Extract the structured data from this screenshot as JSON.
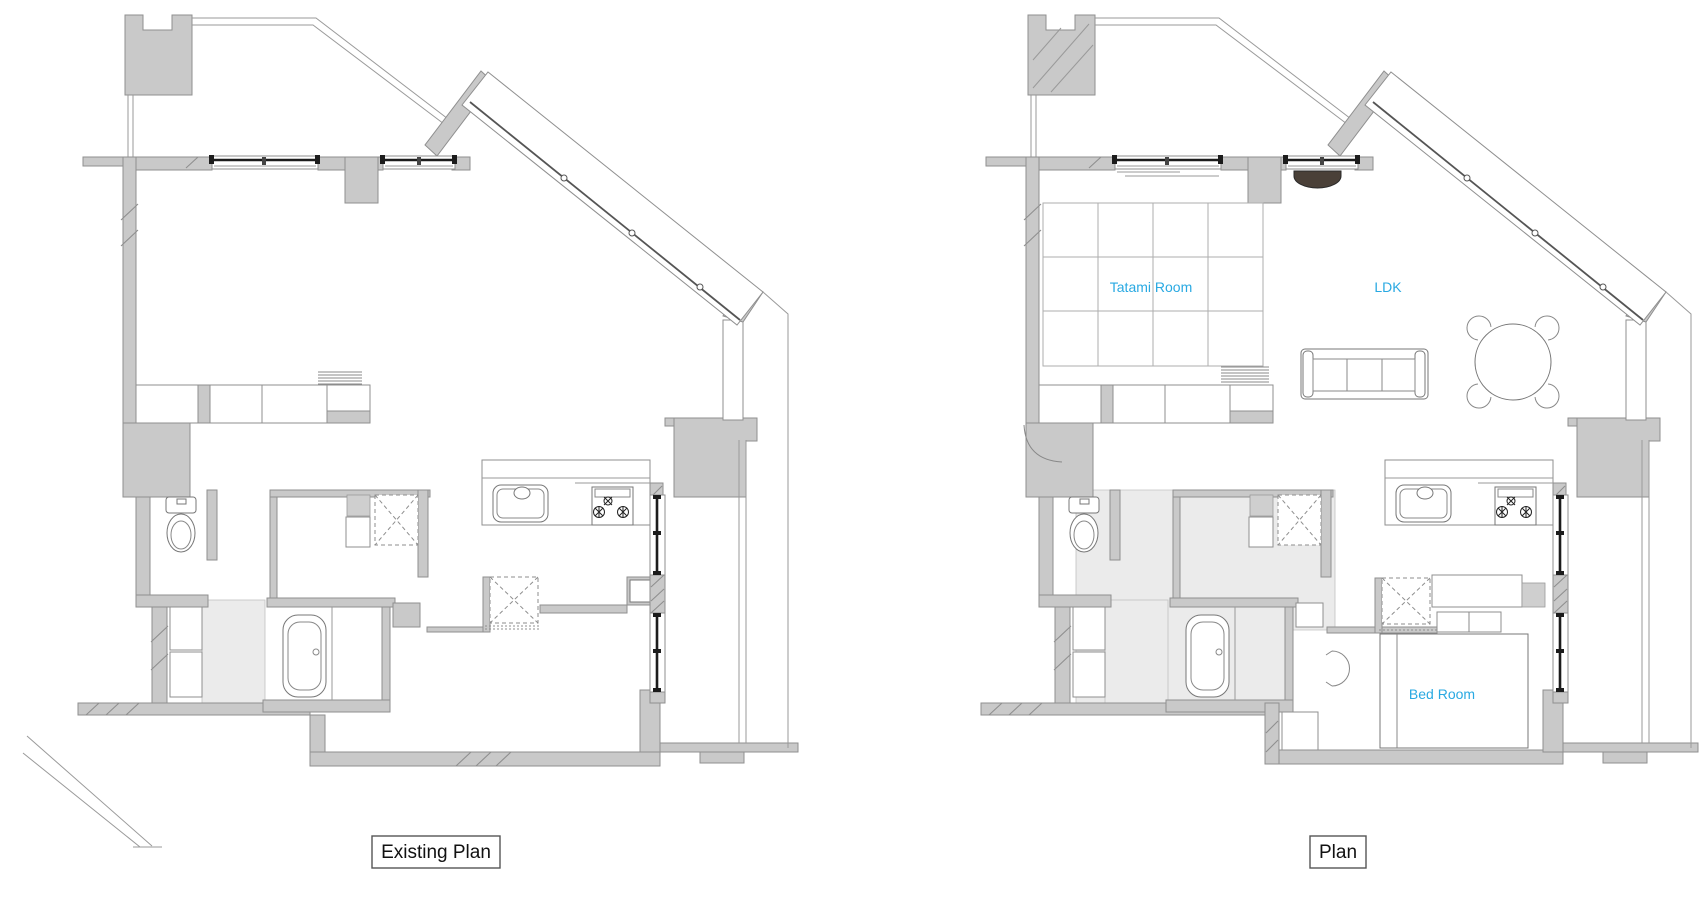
{
  "document": {
    "kind": "architectural-floor-plan-comparison",
    "background": "#ffffff"
  },
  "colors": {
    "room_label_blue": "#29A9E2",
    "wall_gray": "#C9C9C9",
    "light_room_gray": "#EBEBEB"
  },
  "plans": {
    "existing": {
      "title": "Existing Plan"
    },
    "proposed": {
      "title": "Plan",
      "room_labels": {
        "tatami": "Tatami Room",
        "ldk": "LDK",
        "bedroom": "Bed Room"
      }
    }
  }
}
